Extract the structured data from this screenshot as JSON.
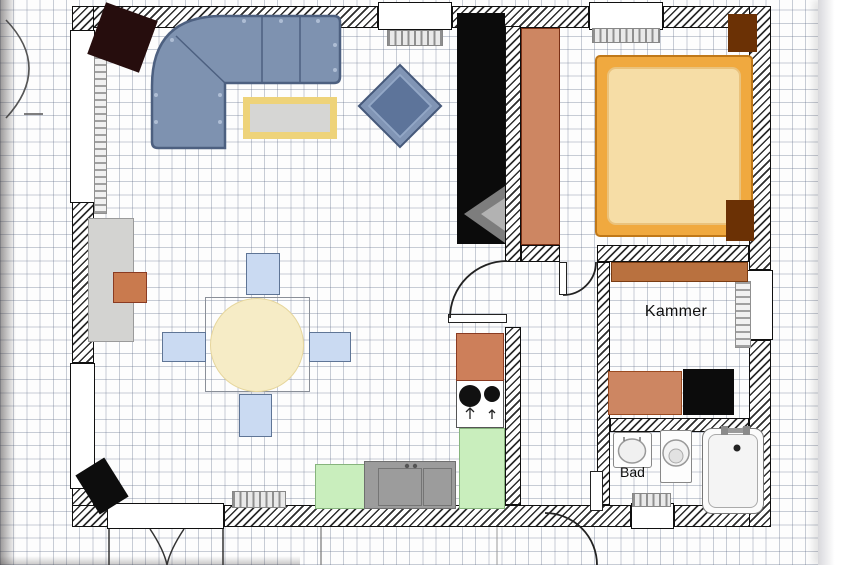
{
  "labels": {
    "kammer": "Kammer",
    "bad": "Bad"
  },
  "plan": {
    "grid_cell_px": 13.2,
    "wall_hatch_color": "#2e2e2e",
    "walls": [
      {
        "name": "wall-top-left",
        "x": 75,
        "y": 6,
        "w": 303,
        "h": 22
      },
      {
        "name": "wall-top-mid",
        "x": 452,
        "y": 6,
        "w": 137,
        "h": 22
      },
      {
        "name": "wall-top-right",
        "x": 663,
        "y": 6,
        "w": 108,
        "h": 22
      },
      {
        "name": "wall-left-top",
        "x": 72,
        "y": 6,
        "w": 22,
        "h": 26
      },
      {
        "name": "wall-left-mid",
        "x": 72,
        "y": 202,
        "w": 22,
        "h": 161
      },
      {
        "name": "wall-left-bottom",
        "x": 72,
        "y": 488,
        "w": 22,
        "h": 39
      },
      {
        "name": "wall-bottom-left",
        "x": 72,
        "y": 505,
        "w": 36,
        "h": 22
      },
      {
        "name": "wall-bottom-mid",
        "x": 224,
        "y": 505,
        "w": 407,
        "h": 22
      },
      {
        "name": "wall-bottom-right",
        "x": 674,
        "y": 505,
        "w": 97,
        "h": 22
      },
      {
        "name": "wall-right-top",
        "x": 749,
        "y": 6,
        "w": 22,
        "h": 264
      },
      {
        "name": "wall-right-bottom",
        "x": 749,
        "y": 340,
        "w": 22,
        "h": 187
      },
      {
        "name": "wall-living-hall-upper",
        "x": 505,
        "y": 26,
        "w": 16,
        "h": 236
      },
      {
        "name": "wall-living-hall-lower",
        "x": 505,
        "y": 327,
        "w": 16,
        "h": 178
      },
      {
        "name": "wall-bedroom-hall",
        "x": 521,
        "y": 245,
        "w": 39,
        "h": 17
      },
      {
        "name": "wall-bedroom-kammer",
        "x": 597,
        "y": 245,
        "w": 152,
        "h": 17
      },
      {
        "name": "wall-hall-kammer-bad",
        "x": 597,
        "y": 262,
        "w": 13,
        "h": 243
      },
      {
        "name": "wall-kammer-bad",
        "x": 610,
        "y": 418,
        "w": 139,
        "h": 14
      }
    ],
    "windows": [
      {
        "name": "window-top-living",
        "x": 378,
        "y": 2,
        "w": 74,
        "h": 28
      },
      {
        "name": "window-top-bedroom",
        "x": 589,
        "y": 2,
        "w": 74,
        "h": 28
      },
      {
        "name": "window-left-upper",
        "x": 70,
        "y": 30,
        "w": 25,
        "h": 173
      },
      {
        "name": "window-left-lower",
        "x": 70,
        "y": 363,
        "w": 25,
        "h": 126
      },
      {
        "name": "window-right-kammer",
        "x": 747,
        "y": 270,
        "w": 26,
        "h": 70
      },
      {
        "name": "window-bottom-bath",
        "x": 631,
        "y": 503,
        "w": 43,
        "h": 26
      },
      {
        "name": "french-door-opening",
        "x": 107,
        "y": 503,
        "w": 117,
        "h": 26
      }
    ],
    "radiators": [
      {
        "name": "radiator-living-top",
        "x": 387,
        "y": 30,
        "w": 56,
        "h": 16,
        "dir": "v"
      },
      {
        "name": "radiator-bedroom",
        "x": 592,
        "y": 28,
        "w": 68,
        "h": 15,
        "dir": "v"
      },
      {
        "name": "radiator-living-bottom",
        "x": 232,
        "y": 491,
        "w": 54,
        "h": 17,
        "dir": "v"
      },
      {
        "name": "radiator-left-wall",
        "x": 94,
        "y": 36,
        "w": 13,
        "h": 178,
        "dir": "h"
      },
      {
        "name": "shelf-kammer-right",
        "x": 735,
        "y": 281,
        "w": 16,
        "h": 67,
        "dir": "h"
      },
      {
        "name": "rug-bad",
        "x": 632,
        "y": 493,
        "w": 39,
        "h": 14,
        "dir": "v"
      }
    ],
    "furniture": [
      {
        "name": "side-table-dark",
        "x": 95,
        "y": 10,
        "w": 55,
        "h": 55,
        "rot": 20,
        "bg": "#260d0d"
      },
      {
        "name": "coffee-table",
        "x": 243,
        "y": 97,
        "w": 94,
        "h": 42,
        "bg": "#d6d6d4",
        "border": "7px solid #eed37a"
      },
      {
        "name": "tv-cabinet",
        "x": 457,
        "y": 13,
        "w": 48,
        "h": 231,
        "bg": "#0b0b0b"
      },
      {
        "name": "sideboard",
        "x": 88,
        "y": 218,
        "w": 46,
        "h": 124,
        "bg": "#d3d3d1",
        "border": "1px solid #9a9a9a"
      },
      {
        "name": "box-on-sideboard",
        "x": 113,
        "y": 272,
        "w": 34,
        "h": 31,
        "bg": "#c97a4e",
        "border": "1px solid #8a3b22"
      },
      {
        "name": "armchair",
        "x": 370,
        "y": 76,
        "w": 60,
        "h": 60,
        "rot": 45,
        "bg": "#8195b5",
        "border": "2px solid #46597a"
      },
      {
        "name": "armchair-seat",
        "x": 377,
        "y": 83,
        "w": 46,
        "h": 46,
        "rot": 45,
        "bg": "#5d749a",
        "border": "2px solid #93a7c6"
      },
      {
        "name": "dining-table-outline",
        "x": 205,
        "y": 297,
        "w": 105,
        "h": 95,
        "bg": "transparent",
        "border": "1px solid #8a8f98"
      },
      {
        "name": "dining-table-top",
        "x": 210,
        "y": 298,
        "w": 94,
        "h": 94,
        "bg": "#f6ecc6",
        "border": "1px solid #e6d69c",
        "round": true
      },
      {
        "name": "chair-north",
        "x": 246,
        "y": 253,
        "w": 34,
        "h": 42,
        "bg": "#cadaf2",
        "border": "1.5px solid #5f7596"
      },
      {
        "name": "chair-west",
        "x": 162,
        "y": 332,
        "w": 44,
        "h": 30,
        "bg": "#cadaf2",
        "border": "1.5px solid #5f7596"
      },
      {
        "name": "chair-east",
        "x": 309,
        "y": 332,
        "w": 42,
        "h": 30,
        "bg": "#cadaf2",
        "border": "1.5px solid #5f7596"
      },
      {
        "name": "chair-south",
        "x": 239,
        "y": 394,
        "w": 33,
        "h": 43,
        "bg": "#cadaf2",
        "border": "1.5px solid #5f7596"
      },
      {
        "name": "speaker-bottom-left",
        "x": 85,
        "y": 463,
        "w": 34,
        "h": 46,
        "rot": -32,
        "bg": "#0d0d0d"
      },
      {
        "name": "counter-green-left",
        "x": 315,
        "y": 464,
        "w": 50,
        "h": 45,
        "bg": "#c9eebd",
        "border": "1px solid #86b47c"
      },
      {
        "name": "sink-unit",
        "x": 364,
        "y": 461,
        "w": 92,
        "h": 48,
        "bg": "#9c9c9c",
        "border": "1px solid #6f6f6f"
      },
      {
        "name": "sink-basin-left",
        "x": 378,
        "y": 468,
        "w": 44,
        "h": 38,
        "bg": "transparent",
        "border": "1.5px solid #757575"
      },
      {
        "name": "sink-basin-right",
        "x": 423,
        "y": 468,
        "w": 29,
        "h": 38,
        "bg": "transparent",
        "border": "1.5px solid #757575"
      },
      {
        "name": "counter-green-right",
        "x": 459,
        "y": 428,
        "w": 46,
        "h": 81,
        "bg": "#c9eebd",
        "border": "1px solid #86b47c"
      },
      {
        "name": "stove",
        "x": 456,
        "y": 380,
        "w": 48,
        "h": 48,
        "bg": "#ffffff",
        "border": "1px solid #555555"
      },
      {
        "name": "kitchen-cabinet",
        "x": 456,
        "y": 333,
        "w": 48,
        "h": 48,
        "bg": "#cd7f5a",
        "border": "1px solid #8a3b22"
      },
      {
        "name": "wardrobe-bedroom",
        "x": 521,
        "y": 28,
        "w": 39,
        "h": 217,
        "bg": "#cd8662",
        "border": "1px solid #7a3015"
      },
      {
        "name": "bed-frame",
        "x": 595,
        "y": 55,
        "w": 158,
        "h": 182,
        "bg": "#f0a93f",
        "border": "2px solid #c07818",
        "r": 5
      },
      {
        "name": "bed-mattress",
        "x": 607,
        "y": 67,
        "w": 134,
        "h": 158,
        "bg": "#f6dda6",
        "border": "2px solid #eac27c",
        "r": 9
      },
      {
        "name": "nightstand-bedroom",
        "x": 728,
        "y": 14,
        "w": 29,
        "h": 38,
        "bg": "#6b3105"
      },
      {
        "name": "bed-footboard",
        "x": 726,
        "y": 200,
        "w": 28,
        "h": 41,
        "bg": "#6b3105"
      },
      {
        "name": "shelf-kammer-top",
        "x": 611,
        "y": 262,
        "w": 137,
        "h": 20,
        "bg": "#b9713f",
        "border": "1px solid #7a3c12"
      },
      {
        "name": "cabinet-kammer-orange",
        "x": 608,
        "y": 371,
        "w": 74,
        "h": 44,
        "bg": "#cd8662",
        "border": "1px solid #9a4a20"
      },
      {
        "name": "cabinet-kammer-black",
        "x": 683,
        "y": 369,
        "w": 51,
        "h": 46,
        "bg": "#0c0c0c"
      },
      {
        "name": "washbasin",
        "x": 613,
        "y": 432,
        "w": 39,
        "h": 36,
        "bg": "#fdfdfd",
        "border": "1px solid #888888",
        "r": 3
      },
      {
        "name": "toilet-body",
        "x": 660,
        "y": 430,
        "w": 32,
        "h": 53,
        "bg": "#fdfdfd",
        "border": "1px solid #888888",
        "r": 2
      },
      {
        "name": "bathtub",
        "x": 702,
        "y": 428,
        "w": 62,
        "h": 86,
        "bg": "#fbfbfb",
        "border": "1.5px solid #777777",
        "r": 10
      },
      {
        "name": "bathtub-inner",
        "x": 708,
        "y": 434,
        "w": 50,
        "h": 74,
        "bg": "#f4f4f4",
        "border": "1px solid #aaaaaa",
        "r": 8
      },
      {
        "name": "door-leaf-living",
        "x": 448,
        "y": 314,
        "w": 59,
        "h": 9,
        "bg": "#ffffff",
        "border": "1.5px solid #222222"
      },
      {
        "name": "door-leaf-bedroom",
        "x": 559,
        "y": 262,
        "w": 8,
        "h": 33,
        "bg": "#ffffff",
        "border": "1.5px solid #222222"
      },
      {
        "name": "door-leaf-entry",
        "x": 590,
        "y": 471,
        "w": 13,
        "h": 40,
        "bg": "#ffffff",
        "border": "1.5px solid #222222"
      }
    ],
    "svg_shapes": [
      {
        "name": "sofa-body",
        "kind": "path",
        "d": "M 225 148 L 158 148 Q 152 148 152 142 L 152 86 Q 152 16 222 16 L 334 16 Q 340 16 340 22 L 340 77 Q 340 83 334 83 L 225 83 Z",
        "fill": "#7e92b0",
        "stroke": "#4d6080",
        "sw": 2.5
      },
      {
        "name": "sofa-seams",
        "kind": "path",
        "d": "M 262 17 V 82 M 300 17 V 82 M 225 83 L 176 36 M 225 84 V 147",
        "fill": "none",
        "stroke": "#4d6080",
        "sw": 1.5
      },
      {
        "name": "sofa-button-1",
        "kind": "circle",
        "cx": 244,
        "cy": 21,
        "r": 2,
        "fill": "#aebdd4"
      },
      {
        "name": "sofa-button-2",
        "kind": "circle",
        "cx": 281,
        "cy": 21,
        "r": 2,
        "fill": "#aebdd4"
      },
      {
        "name": "sofa-button-3",
        "kind": "circle",
        "cx": 318,
        "cy": 21,
        "r": 2,
        "fill": "#aebdd4"
      },
      {
        "name": "sofa-button-4",
        "kind": "circle",
        "cx": 335,
        "cy": 45,
        "r": 2,
        "fill": "#aebdd4"
      },
      {
        "name": "sofa-button-5",
        "kind": "circle",
        "cx": 335,
        "cy": 70,
        "r": 2,
        "fill": "#aebdd4"
      },
      {
        "name": "sofa-button-6",
        "kind": "circle",
        "cx": 156,
        "cy": 95,
        "r": 2,
        "fill": "#aebdd4"
      },
      {
        "name": "sofa-button-7",
        "kind": "circle",
        "cx": 156,
        "cy": 122,
        "r": 2,
        "fill": "#aebdd4"
      },
      {
        "name": "sofa-button-8",
        "kind": "circle",
        "cx": 220,
        "cy": 95,
        "r": 2,
        "fill": "#aebdd4"
      },
      {
        "name": "sofa-button-9",
        "kind": "circle",
        "cx": 220,
        "cy": 122,
        "r": 2,
        "fill": "#aebdd4"
      },
      {
        "name": "sofa-button-10",
        "kind": "circle",
        "cx": 172,
        "cy": 40,
        "r": 2,
        "fill": "#aebdd4"
      },
      {
        "name": "tv-wedge-dark",
        "kind": "polygon",
        "points": "505,186 464,214 505,243",
        "fill": "#7d7d7d"
      },
      {
        "name": "tv-wedge-light",
        "kind": "polygon",
        "points": "505,198 481,214 505,231",
        "fill": "#b2b2b2"
      },
      {
        "name": "door-arc-living",
        "kind": "path",
        "d": "M 450 318 A 57 57 0 0 1 507 261",
        "fill": "none",
        "stroke": "#222222",
        "sw": 1.8
      },
      {
        "name": "door-arc-bedroom",
        "kind": "path",
        "d": "M 563 295 A 33 33 0 0 0 596 262",
        "fill": "none",
        "stroke": "#222222",
        "sw": 1.8
      },
      {
        "name": "door-arc-entry",
        "kind": "path",
        "d": "M 545 513 A 52 52 0 0 1 597 565",
        "fill": "none",
        "stroke": "#222222",
        "sw": 1.8
      },
      {
        "name": "french-door-arc-left",
        "kind": "path",
        "d": "M 150 529 Q 164 550 167 565",
        "fill": "none",
        "stroke": "#333333",
        "sw": 1.5
      },
      {
        "name": "french-door-arc-right",
        "kind": "path",
        "d": "M 184 529 Q 170 550 167 565",
        "fill": "none",
        "stroke": "#333333",
        "sw": 1.5
      },
      {
        "name": "french-door-post-left",
        "kind": "path",
        "d": "M 109 529 V 565",
        "fill": "none",
        "stroke": "#333333",
        "sw": 1.5
      },
      {
        "name": "french-door-post-right",
        "kind": "path",
        "d": "M 223 529 V 565",
        "fill": "none",
        "stroke": "#333333",
        "sw": 1.5
      },
      {
        "name": "terrace-line-left",
        "kind": "path",
        "d": "M 321 527 V 565",
        "fill": "none",
        "stroke": "#777777",
        "sw": 1.2
      },
      {
        "name": "terrace-line-right",
        "kind": "path",
        "d": "M 497 527 V 565",
        "fill": "none",
        "stroke": "#999999",
        "sw": 1
      },
      {
        "name": "tree-arc-outside",
        "kind": "path",
        "d": "M 6 20 Q 52 68 6 118",
        "fill": "none",
        "stroke": "#555555",
        "sw": 1.6
      },
      {
        "name": "tree-tick-outside",
        "kind": "path",
        "d": "M 24 114 L 43 114",
        "fill": "none",
        "stroke": "#555555",
        "sw": 1.4
      },
      {
        "name": "washbasin-bowl",
        "kind": "ellipse",
        "cx": 632,
        "cy": 451,
        "rx": 13.5,
        "ry": 12,
        "fill": "#f0f0f0",
        "stroke": "#999999",
        "sw": 1.5
      },
      {
        "name": "washbasin-taps",
        "kind": "path",
        "d": "M 624 437 V 441 M 640 437 V 441",
        "fill": "none",
        "stroke": "#777777",
        "sw": 1.5
      },
      {
        "name": "toilet-bowl-outer",
        "kind": "circle",
        "cx": 676,
        "cy": 453,
        "r": 13,
        "fill": "#f3f3f3",
        "stroke": "#999999",
        "sw": 1.5
      },
      {
        "name": "toilet-bowl-inner",
        "kind": "circle",
        "cx": 676,
        "cy": 456,
        "r": 7,
        "fill": "#e2e2e2",
        "stroke": "#aaaaaa",
        "sw": 1
      },
      {
        "name": "tub-faucet-bar",
        "kind": "rect",
        "x": 722,
        "y": 428,
        "w": 28,
        "h": 5,
        "fill": "#9a9a9a"
      },
      {
        "name": "tub-handle-left",
        "kind": "rect",
        "x": 721,
        "y": 426,
        "w": 7,
        "h": 9,
        "fill": "#8a8a8a"
      },
      {
        "name": "tub-handle-right",
        "kind": "rect",
        "x": 743,
        "y": 426,
        "w": 7,
        "h": 9,
        "fill": "#8a8a8a"
      },
      {
        "name": "tub-drain-dot",
        "kind": "circle",
        "cx": 737,
        "cy": 448,
        "r": 3.5,
        "fill": "#222222"
      },
      {
        "name": "stove-burner-large",
        "kind": "circle",
        "cx": 470,
        "cy": 396,
        "r": 11,
        "fill": "#111111"
      },
      {
        "name": "stove-burner-small",
        "kind": "circle",
        "cx": 492,
        "cy": 394,
        "r": 8,
        "fill": "#111111"
      },
      {
        "name": "stove-arrow-left",
        "kind": "path",
        "d": "M 470 419 V 408 M 466 412 L 470 408 L 474 412",
        "fill": "none",
        "stroke": "#222222",
        "sw": 1.3
      },
      {
        "name": "stove-arrow-right",
        "kind": "path",
        "d": "M 492 419 V 410 M 489 413 L 492 410 L 495 413",
        "fill": "none",
        "stroke": "#222222",
        "sw": 1.3
      },
      {
        "name": "sink-tap-dot-1",
        "kind": "circle",
        "cx": 407,
        "cy": 466,
        "r": 2.2,
        "fill": "#555555"
      },
      {
        "name": "sink-tap-dot-2",
        "kind": "circle",
        "cx": 415,
        "cy": 466,
        "r": 2.2,
        "fill": "#555555"
      }
    ]
  }
}
